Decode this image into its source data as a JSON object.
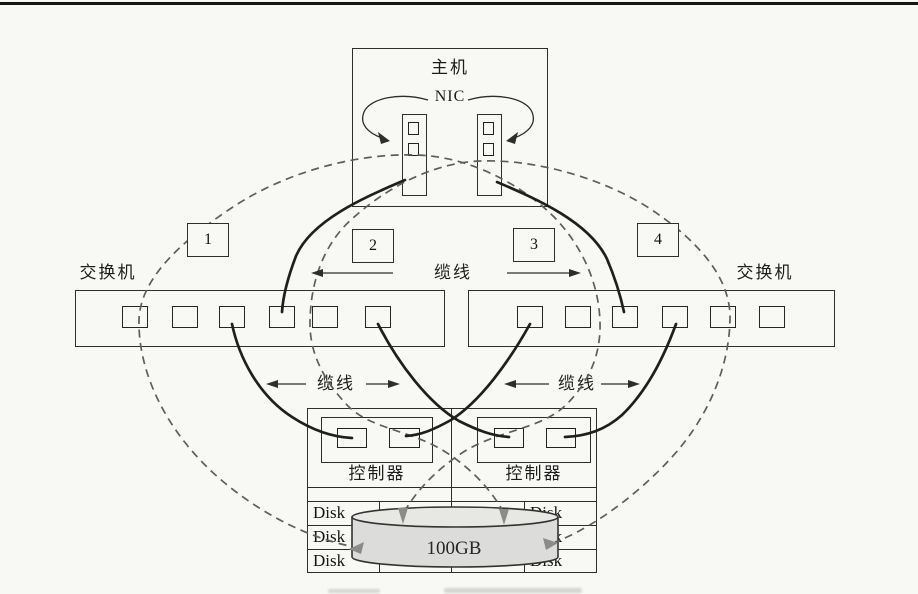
{
  "host": {
    "label": "主机",
    "nic_label": "NIC"
  },
  "path_labels": [
    "1",
    "2",
    "3",
    "4"
  ],
  "switches": {
    "left_label": "交换机",
    "right_label": "交换机"
  },
  "cables": {
    "top_label": "缆线",
    "bottom_left_label": "缆线",
    "bottom_right_label": "缆线"
  },
  "controllers": {
    "left_label": "控制器",
    "right_label": "控制器"
  },
  "disk_array": {
    "cells": [
      "Disk",
      "Disk",
      "Disk",
      "Disk",
      "Disk",
      "Disk"
    ],
    "lun_label": "100GB"
  },
  "colors": {
    "line": "#2b2b2b",
    "dashed_path": "#5e5e5e",
    "cylinder_fill": "#dcdcda",
    "cylinder_top_fill": "#e7e7e4",
    "gray_arrow": "#8b8b8b",
    "paper": "#f8f8f5"
  }
}
